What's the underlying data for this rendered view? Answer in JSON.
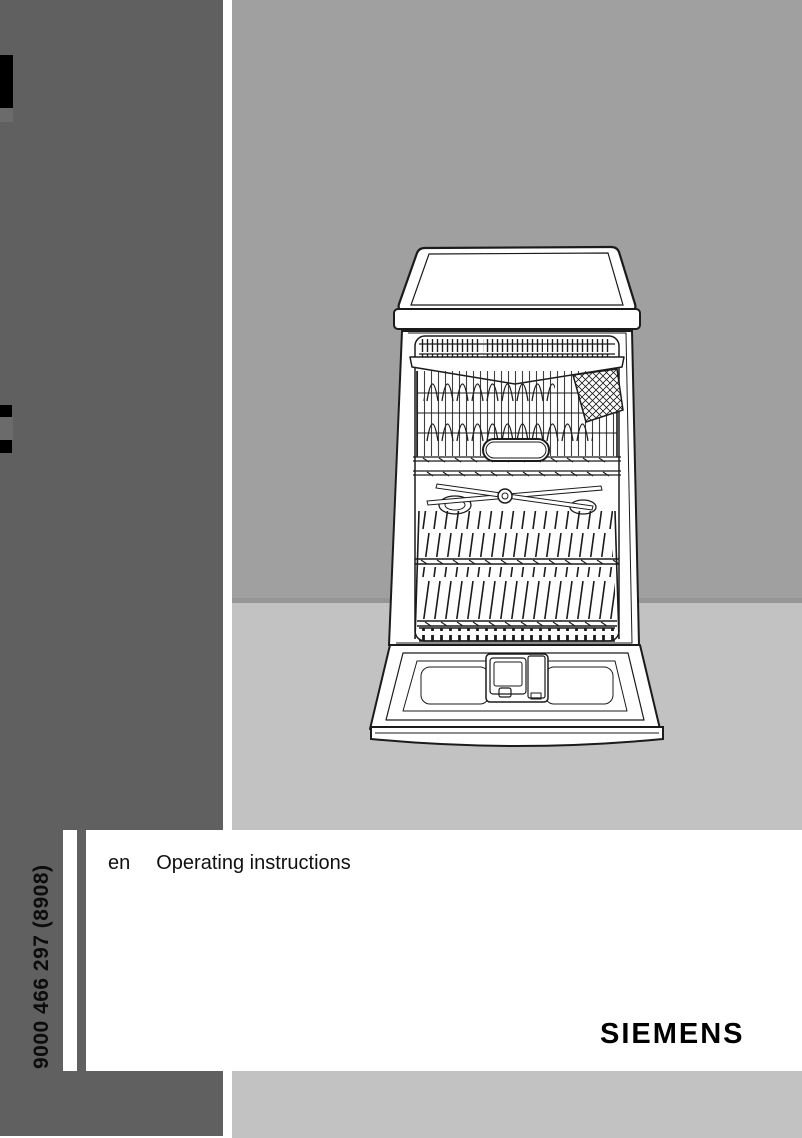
{
  "cover": {
    "order_code": "9000 466 297 (8908)",
    "language_code": "en",
    "title": "Operating instructions",
    "brand_logo": "SIEMENS"
  },
  "illustration": {
    "name": "dishwasher-line-drawing",
    "description": "Line drawing of a freestanding dishwasher with worktop, cutlery drawer, upper basket, spray arm, lower basket and open door with detergent dispenser"
  },
  "colors": {
    "side_band": "#606060",
    "tab_mark": "#000000",
    "illustration_bg_upper": "#a0a0a0",
    "illustration_bg_lower": "#c2c2c2",
    "footer_bar": "#c2c2c2",
    "text": "#101010"
  }
}
